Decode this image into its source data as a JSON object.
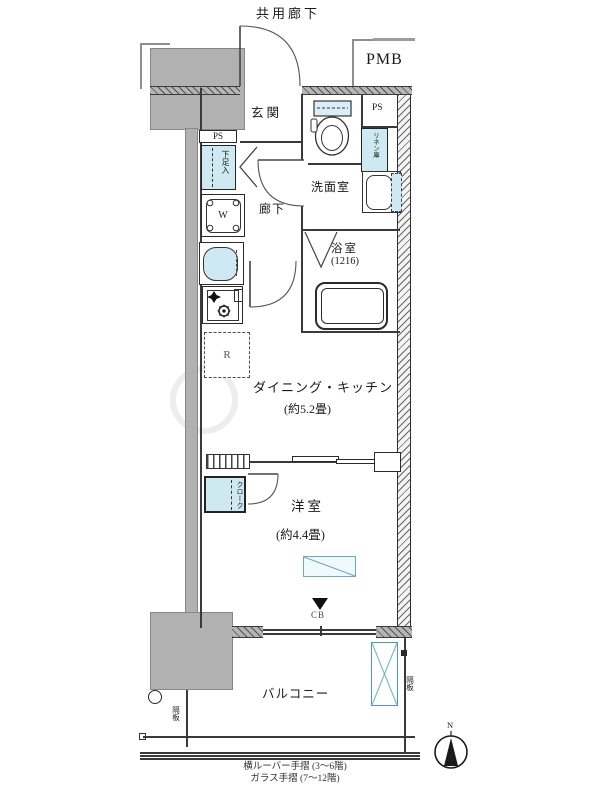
{
  "plan": {
    "common_corridor": "共用廊下",
    "pmb": "PMB",
    "ps_top_left": "PS",
    "ps_top_right": "PS",
    "entrance": "玄関",
    "shoe_cabinet": "下足入",
    "linen_closet": "リネン庫",
    "hallway": "廊下",
    "washroom": "洗面室",
    "bathroom": "浴室",
    "bathroom_size": "(1216)",
    "washer": "W",
    "fridge": "R",
    "dining_kitchen": "ダイニング・キッチン",
    "dining_kitchen_size": "(約5.2畳)",
    "closet": "クローク",
    "bedroom": "洋室",
    "bedroom_size": "(約4.4畳)",
    "cb_marker": "CB",
    "balcony": "バルコニー",
    "divider_left": "隔板",
    "divider_right": "隔板",
    "note_line1": "横ルーバー手摺 (3〜6階)",
    "note_line2": "ガラス手摺 (7〜12階)",
    "compass_north": "N"
  },
  "colors": {
    "fixture_blue": "#cfe9f3",
    "wall_gray": "#b1b1b1",
    "line_dark": "#1a1a1a"
  }
}
